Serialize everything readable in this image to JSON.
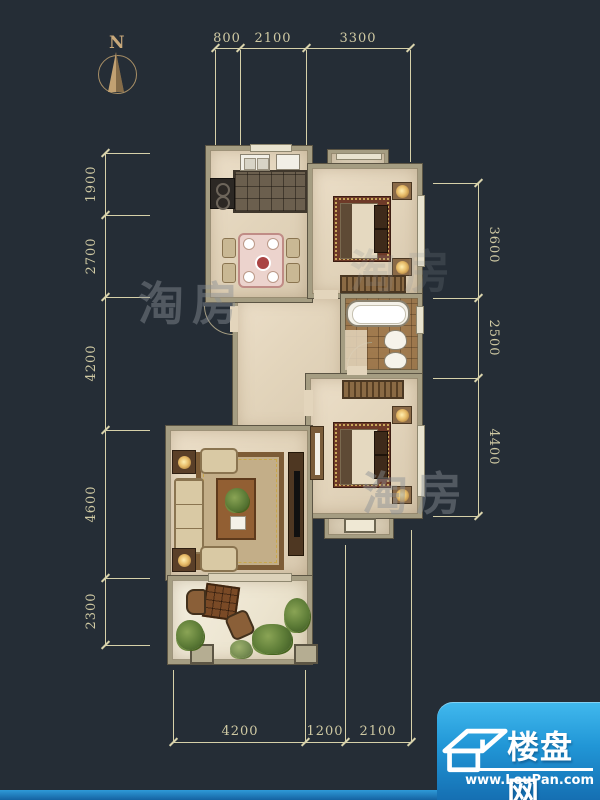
{
  "compass": {
    "label": "N"
  },
  "dimensions": {
    "top": [
      "800",
      "2100",
      "3300"
    ],
    "left": [
      "1900",
      "2700",
      "4200",
      "4600",
      "2300"
    ],
    "right": [
      "3600",
      "2500",
      "4400"
    ],
    "bottom": [
      "4200",
      "1200",
      "2100"
    ]
  },
  "watermark": {
    "text": "淘房"
  },
  "logo": {
    "title": "楼盘网",
    "url": "www.LouPan.com"
  },
  "colors": {
    "background": "#252d36",
    "dimension_line": "#d6d0a9",
    "wall": "#a59d82",
    "floor": "#e8dcc5",
    "logo_blue_top": "#41b9ee",
    "logo_blue_bottom": "#156fb2"
  }
}
